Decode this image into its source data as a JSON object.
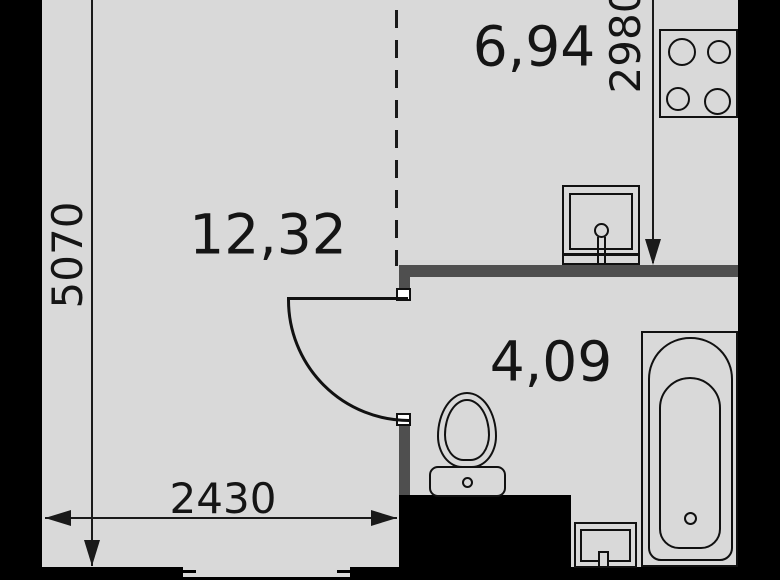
{
  "plan": {
    "title": "studio-apartment-floor-plan",
    "rooms": [
      {
        "id": "living-room",
        "area": "12,32"
      },
      {
        "id": "kitchen",
        "area": "6,94"
      },
      {
        "id": "bathroom",
        "area": "4,09"
      }
    ],
    "dimensions": {
      "left_height": "5070",
      "kitchen_height": "2980",
      "bottom_width": "2430"
    },
    "fixtures": [
      "stove-icon",
      "kitchen-sink-icon",
      "toilet-icon",
      "bathroom-sink-icon",
      "bathtub-icon",
      "door-swing",
      "window"
    ],
    "colors": {
      "floor": "#d9d9d9",
      "wall_black": "#000000",
      "wall_gray": "#4f4f4f",
      "line": "#1a1a1a"
    }
  }
}
